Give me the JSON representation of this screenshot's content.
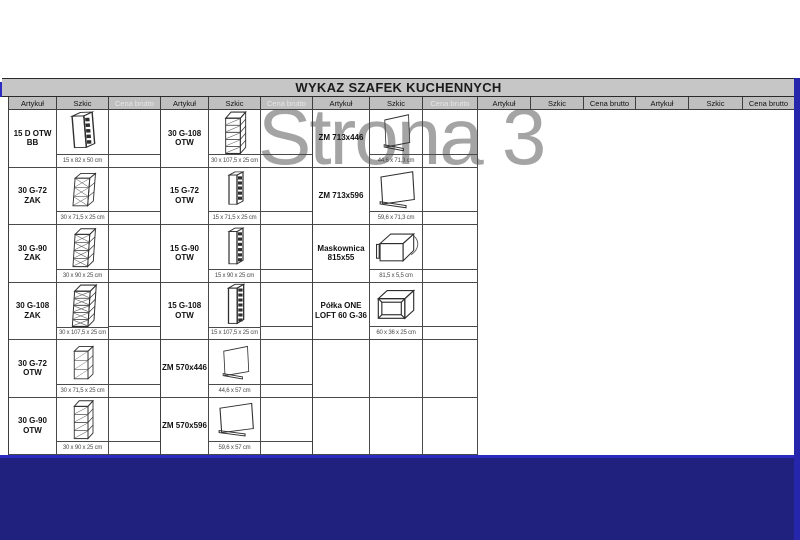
{
  "title": "WYKAZ SZAFEK KUCHENNYCH",
  "watermark": "Strona 3",
  "headers": {
    "artykul": "Artykuł",
    "szkic": "Szkic",
    "cena_brutto": "Cena brutto"
  },
  "colors": {
    "navy_fill": "#20207e",
    "navy_line": "#2b2bc0",
    "header_bg": "#bfbfbf",
    "title_bg": "#c6c6c6",
    "muted_header_text": "#e7e7e7",
    "watermark_gray": "#8e8e8e"
  },
  "groups": [
    {
      "rows": [
        {
          "article": "15 D OTW BB",
          "dims": "15 x 82 x 50 cm",
          "sketch": "panel-bb"
        },
        {
          "article": "30 G-72 ZAK",
          "dims": "30 x 71,5 x 25 cm",
          "sketch": "zak-3"
        },
        {
          "article": "30 G-90 ZAK",
          "dims": "30 x 90 x 25 cm",
          "sketch": "zak-4"
        },
        {
          "article": "30 G-108 ZAK",
          "dims": "30 x 107,5 x 25 cm",
          "sketch": "zak-5"
        },
        {
          "article": "30 G-72 OTW",
          "dims": "30 x 71,5 x 25 cm",
          "sketch": "otw-3"
        },
        {
          "article": "30 G-90 OTW",
          "dims": "30 x 90 x 25 cm",
          "sketch": "otw-4"
        }
      ]
    },
    {
      "rows": [
        {
          "article": "30 G-108 OTW",
          "dims": "30 x 107,5 x 25 cm",
          "sketch": "otw-5"
        },
        {
          "article": "15 G-72 OTW",
          "dims": "15 x 71,5 x 25 cm",
          "sketch": "thin-3"
        },
        {
          "article": "15 G-90 OTW",
          "dims": "15 x 90 x 25 cm",
          "sketch": "thin-4"
        },
        {
          "article": "15 G-108 OTW",
          "dims": "15 x 107,5 x 25 cm",
          "sketch": "thin-5"
        },
        {
          "article": "ZM 570x446",
          "dims": "44,6 x 57 cm",
          "sketch": "zm-panel"
        },
        {
          "article": "ZM 570x596",
          "dims": "59,6 x 57 cm",
          "sketch": "zm-panel"
        }
      ]
    },
    {
      "rows": [
        {
          "article": "ZM 713x446",
          "dims": "44,6 x 71,3 cm",
          "sketch": "zm-panel"
        },
        {
          "article": "ZM 713x596",
          "dims": "59,6 x 71,3 cm",
          "sketch": "zm-panel"
        },
        {
          "article": "Maskownica 815x55",
          "dims": "81,5 x 5,5 cm",
          "sketch": "maskownica"
        },
        {
          "article": "Półka ONE LOFT 60 G-36",
          "dims": "60 x 36 x 25 cm",
          "sketch": "shelf-frame"
        },
        {
          "article": "",
          "dims": "",
          "sketch": ""
        },
        {
          "article": "",
          "dims": "",
          "sketch": ""
        }
      ]
    }
  ]
}
